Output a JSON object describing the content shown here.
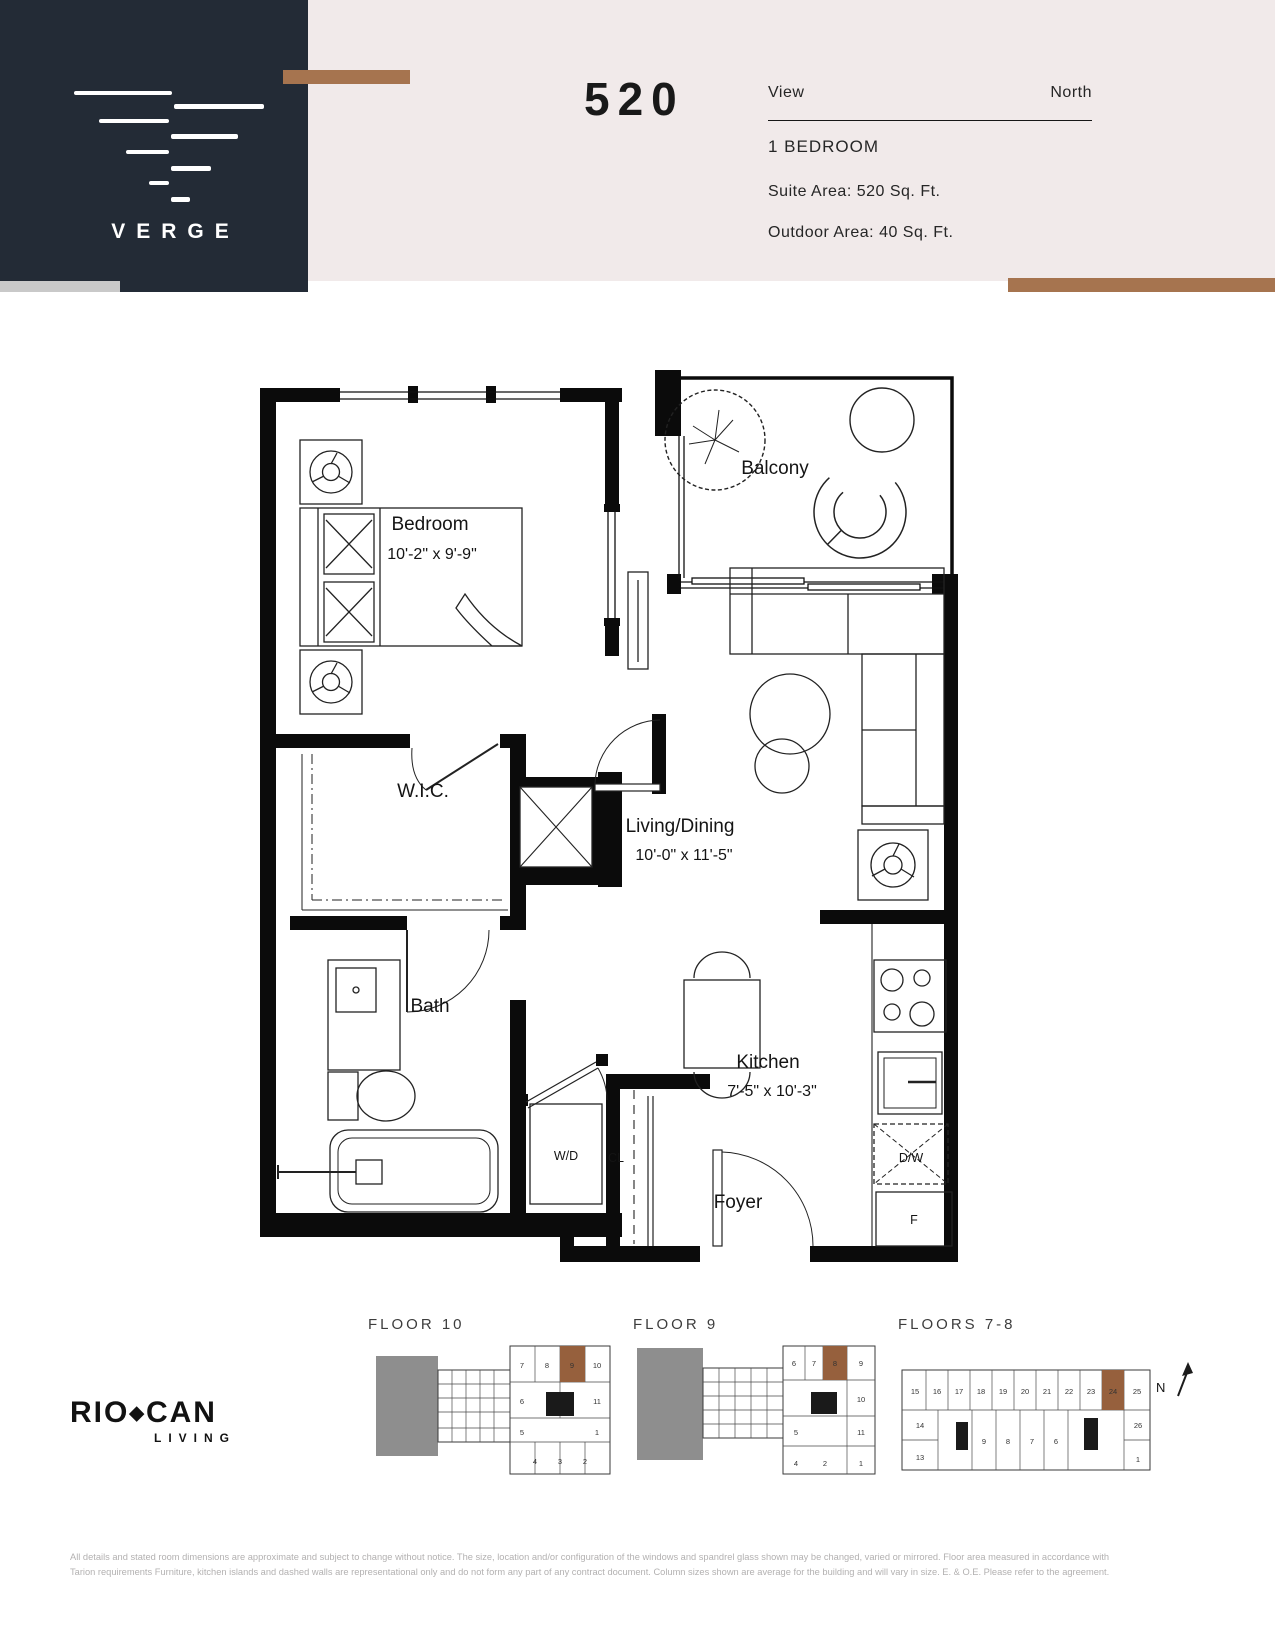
{
  "header": {
    "brand": "VERGE",
    "unit_number": "520",
    "view_label": "View",
    "view_value": "North",
    "unit_type": "1 BEDROOM",
    "suite_area": "Suite Area: 520 Sq. Ft.",
    "outdoor_area": "Outdoor Area: 40 Sq. Ft."
  },
  "rooms": {
    "bedroom": {
      "name": "Bedroom",
      "dims": "10'-2\" x 9'-9\""
    },
    "balcony": {
      "name": "Balcony",
      "dims": ""
    },
    "wic": {
      "name": "W.I.C.",
      "dims": ""
    },
    "living": {
      "name": "Living/Dining",
      "dims": "10'-0\" x 11'-5\""
    },
    "bath": {
      "name": "Bath",
      "dims": ""
    },
    "kitchen": {
      "name": "Kitchen",
      "dims": "7'-5\" x 10'-3\""
    },
    "foyer": {
      "name": "Foyer",
      "dims": ""
    },
    "wd": "W/D",
    "cl": "CL",
    "dw": "D/W",
    "fridge": "F"
  },
  "keyplans": {
    "floor10": {
      "label": "FLOOR 10",
      "highlight_unit": "9",
      "units": [
        "7",
        "8",
        "9",
        "10",
        "6",
        "11",
        "5",
        "1",
        "4",
        "3",
        "2"
      ]
    },
    "floor9": {
      "label": "FLOOR 9",
      "highlight_unit": "8",
      "units": [
        "6",
        "7",
        "8",
        "9",
        "10",
        "11",
        "1",
        "5",
        "4",
        "2"
      ]
    },
    "floors78": {
      "label": "FLOORS 7-8",
      "highlight_unit": "24",
      "units": [
        "15",
        "16",
        "17",
        "18",
        "19",
        "20",
        "21",
        "22",
        "23",
        "24",
        "25",
        "14",
        "13",
        "9",
        "8",
        "7",
        "6",
        "26",
        "1"
      ]
    }
  },
  "compass": "N",
  "footer": {
    "logo_rio": "RIO",
    "logo_diamond": "◆",
    "logo_can": "CAN",
    "logo_sub": "LIVING",
    "disclaimer_line1": "All details and stated room dimensions are approximate and subject to change without notice. The size, location and/or configuration of the windows and spandrel glass shown may be changed, varied or mirrored. Floor area measured in accordance with",
    "disclaimer_line2": "Tarion requirements Furniture, kitchen islands and dashed walls are representational only and do not form any part of any contract document.  Column sizes shown are average for the building and will vary in size. E. & O.E. Please refer to the agreement."
  },
  "colors": {
    "navy": "#232b36",
    "blush": "#f1eaea",
    "accent": "#a6744f",
    "graystrip": "#c9c9c9",
    "kpgray": "#8e8e8e",
    "kpbrown": "#96603d"
  }
}
